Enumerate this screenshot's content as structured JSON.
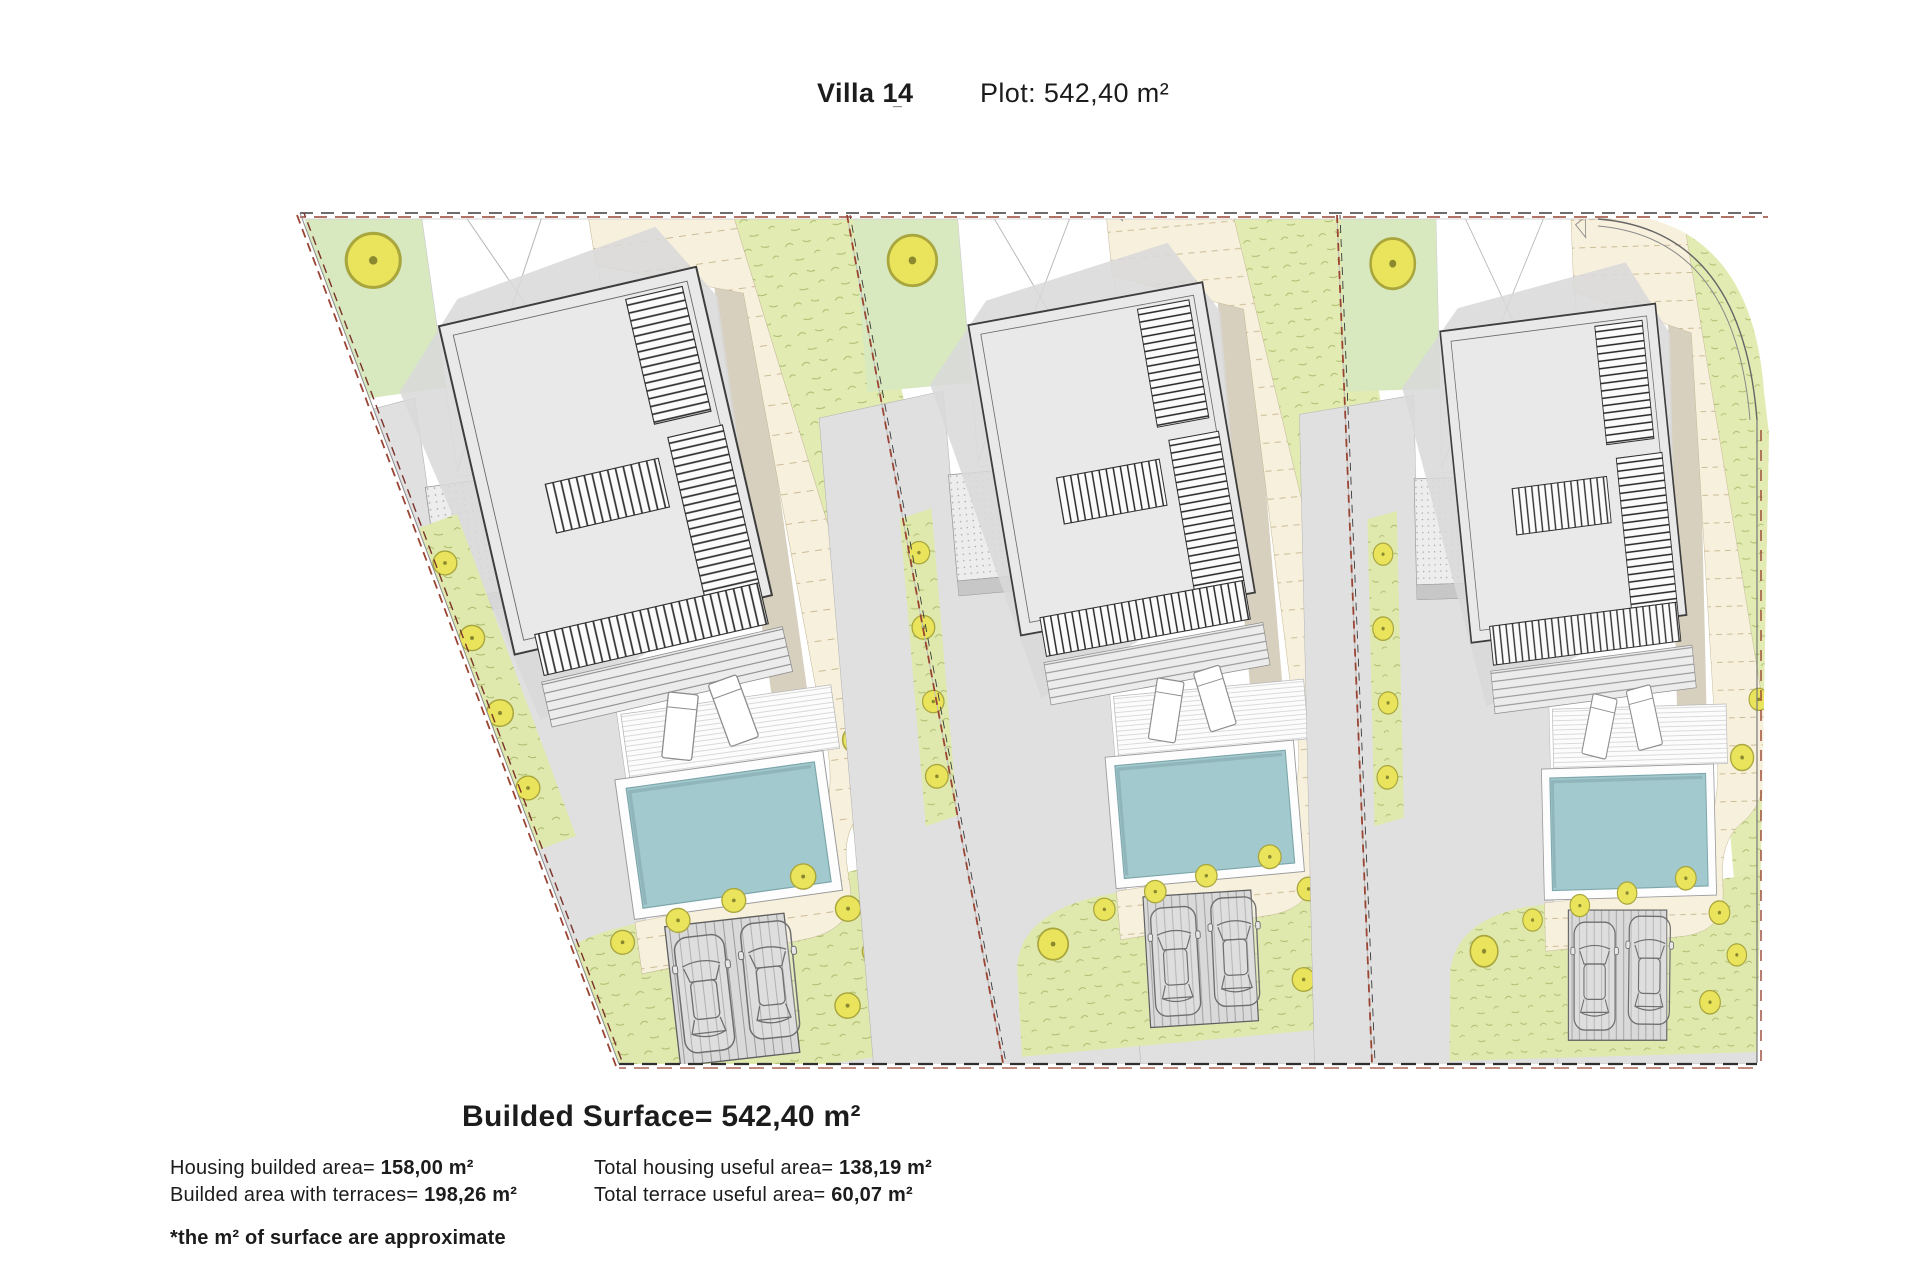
{
  "header": {
    "title": "Villa 14",
    "title_mark": "_",
    "plot": "Plot: 542,40 m²"
  },
  "summary": {
    "heading": "Builded Surface= 542,40 m²",
    "left": [
      {
        "label": "Housing builded area= ",
        "value": "158,00 m²"
      },
      {
        "label": "Builded area with terraces= ",
        "value": "198,26 m²"
      }
    ],
    "right": [
      {
        "label": "Total housing useful area= ",
        "value": "138,19 m²"
      },
      {
        "label": "Total terrace useful area= ",
        "value": "60,07 m²"
      }
    ],
    "footnote": "*the m² of surface are approximate"
  },
  "site_plan": {
    "villas_count": 3,
    "elements": [
      "building",
      "pool",
      "sun-deck",
      "loungers",
      "garden-trees",
      "grass",
      "footpath",
      "driveway",
      "parking-two-cars",
      "plot-boundary"
    ],
    "colors": {
      "grass": "#e1ebb2",
      "garden": "#d8e9c0",
      "tree": "#eae45c",
      "path": "#f7f0dc",
      "slope_tan": "#d8d0be",
      "pool_water": "#a2c9cd",
      "building": "#e9e9e9",
      "roof_shadow": "#d9d9d9",
      "road": "#e0e0e0",
      "boundary_red": "#9a4433",
      "line_dark": "#3c3c3c"
    }
  }
}
